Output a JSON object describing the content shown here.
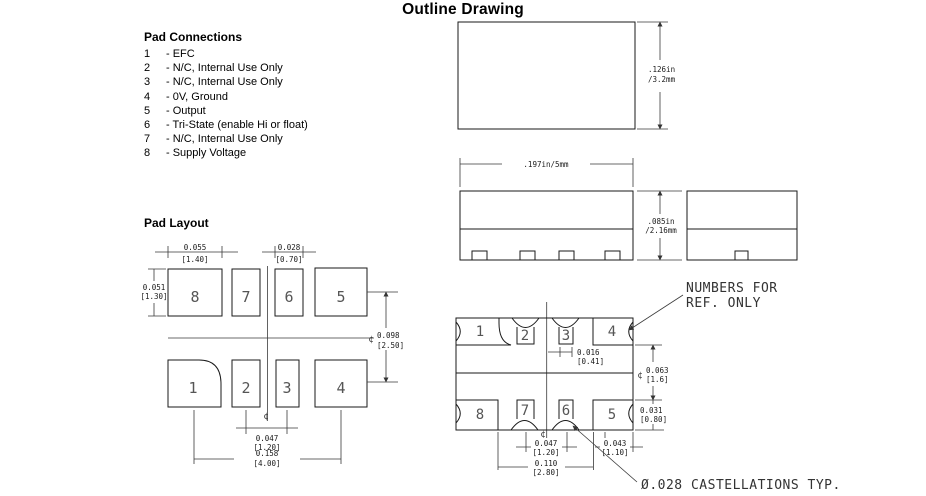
{
  "title": "Outline Drawing",
  "symbols": {
    "centerline": "¢"
  },
  "pad_connections": {
    "heading": "Pad Connections",
    "items": [
      {
        "num": "1",
        "label": "- EFC"
      },
      {
        "num": "2",
        "label": "- N/C, Internal Use Only"
      },
      {
        "num": "3",
        "label": "- N/C, Internal Use Only"
      },
      {
        "num": "4",
        "label": "- 0V, Ground"
      },
      {
        "num": "5",
        "label": "- Output"
      },
      {
        "num": "6",
        "label": "- Tri-State (enable Hi or float)"
      },
      {
        "num": "7",
        "label": "- N/C, Internal Use Only"
      },
      {
        "num": "8",
        "label": "- Supply Voltage"
      }
    ]
  },
  "pad_layout": {
    "heading": "Pad Layout",
    "top_row_pads": [
      "8",
      "7",
      "6",
      "5"
    ],
    "bottom_row_pads": [
      "1",
      "2",
      "3",
      "4"
    ],
    "dims": {
      "pad_large_width": {
        "in": "0.055",
        "mm": "[1.40]"
      },
      "pad_small_width": {
        "in": "0.028",
        "mm": "[0.70]"
      },
      "pad_height": {
        "in": "0.051",
        "mm": "[1.30]"
      },
      "row_pitch": {
        "in": "0.098",
        "mm": "[2.50]"
      },
      "pad_pitch": {
        "in": "0.047",
        "mm": "[1.20]"
      },
      "overall_pitch": {
        "in": "0.158",
        "mm": "[4.00]"
      }
    }
  },
  "outline_views": {
    "top_view": {
      "height_dim_line1": ".126in",
      "height_dim_line2": "/3.2mm"
    },
    "side_view": {
      "width_dim": ".197in/5mm"
    },
    "end_view": {
      "height_dim_line1": ".085in",
      "height_dim_line2": "/2.16mm"
    }
  },
  "bottom_view": {
    "top_row_pads": [
      "1",
      "2",
      "3",
      "4"
    ],
    "bottom_row_pads": [
      "8",
      "7",
      "6",
      "5"
    ],
    "dims": {
      "pad_width": {
        "in": "0.016",
        "mm": "[0.41]"
      },
      "row_gap": {
        "in": "0.063",
        "mm": "[1.6]"
      },
      "pad_height": {
        "in": "0.031",
        "mm": "[0.80]"
      },
      "pad_pitch": {
        "in": "0.047",
        "mm": "[1.20]"
      },
      "corner_pad": {
        "in": "0.043",
        "mm": "[1.10]"
      },
      "span": {
        "in": "0.110",
        "mm": "[2.80]"
      }
    },
    "note_ref_line1": "NUMBERS FOR",
    "note_ref_line2": "REF. ONLY",
    "note_castellations": "Ø.028 CASTELLATIONS TYP."
  }
}
